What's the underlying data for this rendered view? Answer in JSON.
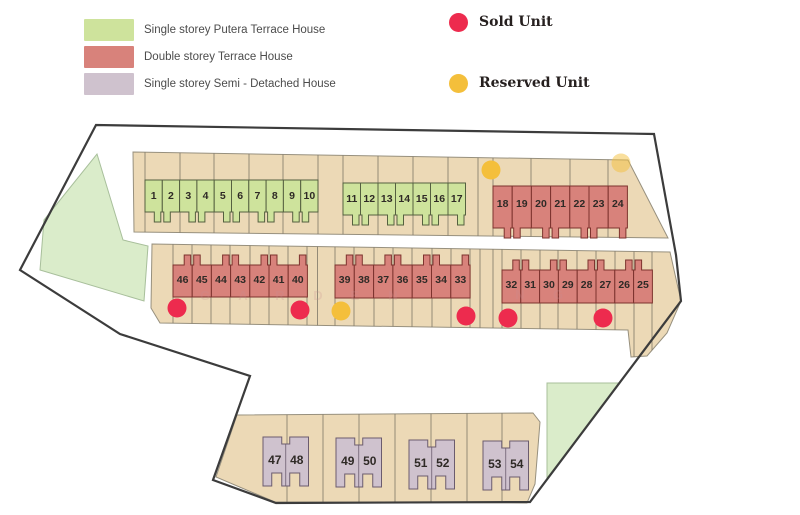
{
  "legend": {
    "types": [
      {
        "label": "Single storey Putera Terrace House",
        "color": "#cee39c"
      },
      {
        "label": "Double storey Terrace House",
        "color": "#d8827b"
      },
      {
        "label": "Single storey Semi - Detached House",
        "color": "#cfc2ce"
      }
    ],
    "status": [
      {
        "label": "Sold Unit",
        "color": "#ed2b4e"
      },
      {
        "label": "Reserved Unit",
        "color": "#f4bf3b"
      }
    ]
  },
  "colors": {
    "background": "#ffffff",
    "boundary": "#3c3c3c",
    "parcel_fill": "#ecd9b6",
    "parcel_stroke": "#97907e",
    "lot_line": "#7d7668",
    "open_space_fill": "#daecca",
    "open_space_stroke": "#a8bf9b",
    "putera_fill": "#cee39c",
    "putera_stroke": "#556040",
    "terrace_fill": "#d8827b",
    "terrace_stroke": "#7d332e",
    "semid_fill": "#cfc2ce",
    "semid_stroke": "#6b5c6e",
    "sold": "#ed2b4e",
    "reserved": "#f4bf3b",
    "number": "#2f2a26",
    "watermark": "#c98f92"
  },
  "map": {
    "boundary_points": "96,125 654,134 676,255 681,301 530,502 276,503 213,480 250,376 120,334 20,270",
    "open_spaces": [
      {
        "name": "open-space-west",
        "points": "97,154 123,240 148,246 144,301 40,270 44,220"
      },
      {
        "name": "open-space-southeast",
        "points": "547,383 620,383 547,478"
      }
    ],
    "parcels": [
      {
        "name": "parcel-north",
        "points": "133,152 628,160 668,238 134,232",
        "lines": [
          145,
          180,
          214,
          249,
          283,
          318,
          343,
          378,
          413,
          448,
          478,
          493,
          531,
          570,
          608
        ]
      },
      {
        "name": "parcel-middle",
        "points": "152,244 670,252 681,301 667,333 647,356 631,357 628,330 160,323 151,308",
        "lines": [
          173,
          192,
          211,
          230,
          250,
          269,
          288,
          307,
          317.5,
          335,
          354,
          374,
          393,
          412,
          432,
          451,
          470,
          480,
          493,
          502,
          521,
          540,
          558,
          577,
          596,
          615,
          634,
          652
        ]
      },
      {
        "name": "parcel-south",
        "points": "237,415 533,413 540,422 535,484 527,503 275,502 216,477",
        "lines": [
          287,
          323,
          359,
          395,
          431,
          467,
          502
        ]
      }
    ],
    "terrace_blocks": [
      {
        "id": "A",
        "type": "putera",
        "lots": [
          1,
          2,
          3,
          4,
          5,
          6,
          7,
          8,
          9,
          10
        ],
        "x0": 145,
        "unit_w": 17.3,
        "top": 180,
        "bottom": 212,
        "dir": "down",
        "num_y": 199
      },
      {
        "id": "B",
        "type": "putera",
        "lots": [
          11,
          12,
          13,
          14,
          15,
          16,
          17
        ],
        "x0": 343,
        "unit_w": 17.5,
        "top": 183,
        "bottom": 215,
        "dir": "down",
        "num_y": 202
      },
      {
        "id": "C",
        "type": "terrace",
        "lots": [
          18,
          19,
          20,
          21,
          22,
          23,
          24
        ],
        "x0": 493,
        "unit_w": 19.2,
        "top": 186,
        "bottom": 228,
        "dir": "down",
        "num_y": 207
      },
      {
        "id": "D",
        "type": "terrace",
        "lots": [
          46,
          45,
          44,
          43,
          42,
          41,
          40
        ],
        "x0": 173,
        "unit_w": 19.2,
        "top": 265,
        "bottom": 297,
        "dir": "up",
        "num_y": 283
      },
      {
        "id": "E",
        "type": "terrace",
        "lots": [
          39,
          38,
          37,
          36,
          35,
          34,
          33
        ],
        "x0": 335,
        "unit_w": 19.3,
        "top": 265,
        "bottom": 298,
        "dir": "up",
        "num_y": 283
      },
      {
        "id": "F",
        "type": "terrace",
        "lots": [
          32,
          31,
          30,
          29,
          28,
          27,
          26,
          25
        ],
        "x0": 502,
        "unit_w": 18.8,
        "top": 270,
        "bottom": 303,
        "dir": "up",
        "num_y": 288
      }
    ],
    "semi_detached_pairs": [
      {
        "lots": [
          47,
          48
        ],
        "x": 263,
        "y": 437
      },
      {
        "lots": [
          49,
          50
        ],
        "x": 336,
        "y": 438
      },
      {
        "lots": [
          51,
          52
        ],
        "x": 409,
        "y": 440
      },
      {
        "lots": [
          53,
          54
        ],
        "x": 483,
        "y": 441
      }
    ],
    "pair_size": {
      "w": 45.5,
      "h": 49
    },
    "status_markers": [
      {
        "x": 491,
        "y": 170,
        "status": "reserved",
        "opacity": 1
      },
      {
        "x": 621,
        "y": 163,
        "status": "reserved",
        "opacity": 0.5
      },
      {
        "x": 177,
        "y": 308,
        "status": "sold",
        "opacity": 1
      },
      {
        "x": 300,
        "y": 310,
        "status": "sold",
        "opacity": 1
      },
      {
        "x": 341,
        "y": 311,
        "status": "reserved",
        "opacity": 1
      },
      {
        "x": 466,
        "y": 316,
        "status": "sold",
        "opacity": 1
      },
      {
        "x": 508,
        "y": 318,
        "status": "sold",
        "opacity": 1
      },
      {
        "x": 603,
        "y": 318,
        "status": "sold",
        "opacity": 1
      }
    ],
    "watermark_letters": [
      {
        "ch": "G",
        "x": 205,
        "y": 300
      },
      {
        "ch": "A",
        "x": 243,
        "y": 300
      },
      {
        "ch": "R",
        "x": 280,
        "y": 300
      },
      {
        "ch": "D",
        "x": 318,
        "y": 300
      },
      {
        "ch": "E",
        "x": 355,
        "y": 300
      },
      {
        "ch": "N",
        "x": 393,
        "y": 300
      },
      {
        "ch": "N",
        "x": 520,
        "y": 299
      },
      {
        "ch": "G",
        "x": 558,
        "y": 299
      }
    ]
  }
}
